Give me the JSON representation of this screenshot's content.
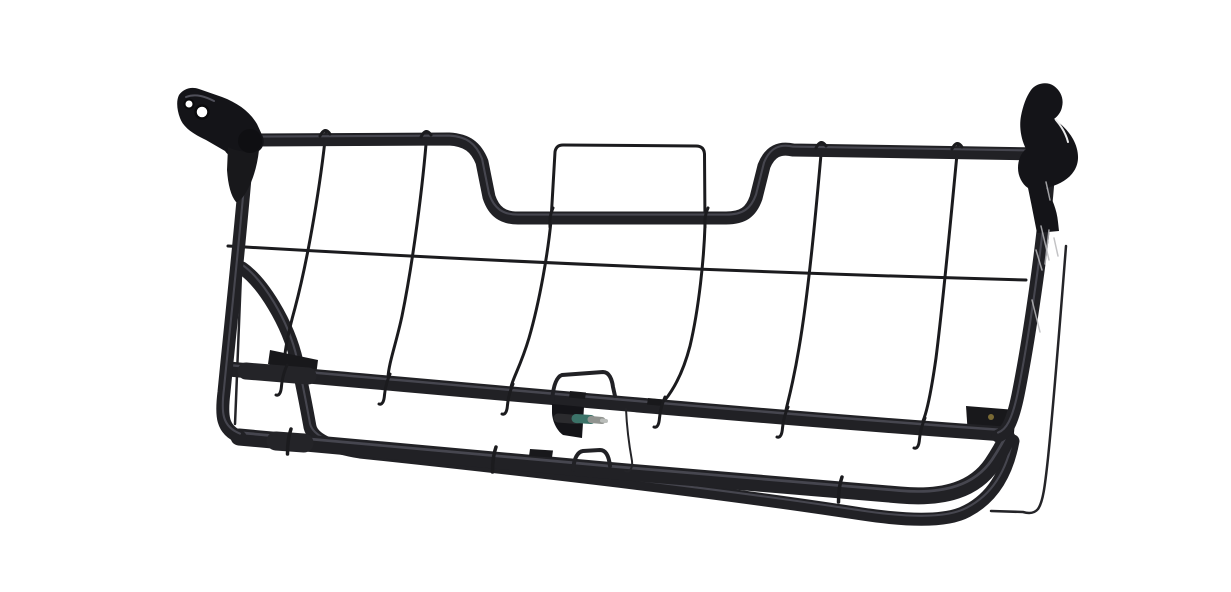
{
  "scene": {
    "type": "product-photo",
    "subject": "Black tubular steel rack frame with wire mesh back panel, mounting brackets and latch bolt",
    "background_color": "#ffffff"
  },
  "art": {
    "viewbox": "0 0 1231 592",
    "palette": {
      "bg": "#ffffff",
      "tube": "#212125",
      "tubeDark": "#18181b",
      "wire": "#1b1b1e",
      "wire2": "#242428",
      "plate": "#141418",
      "boss": "#0f0f12",
      "sheen": "#50505a",
      "scratch": "#b9b9bc",
      "teal": "#3b7268",
      "bolt": "#2b2b2e",
      "boltTip": "#90938f",
      "boltTipEnd": "#babdba",
      "gold": "#7a6a35",
      "notch": "#ececec"
    },
    "parts": [
      {
        "n": "prop-rod-left",
        "t": "path",
        "d": "M 245 175 C 242 250 238 340 236 400 L 235 424",
        "col": "wire2",
        "w": 2.5
      },
      {
        "n": "prop-rod-right",
        "t": "path",
        "d": "M 1066 246 C 1061 310 1054 400 1048 458 C 1045 486 1043 502 1038 509 Q 1033 515 1023 512 L 991 511",
        "col": "wire2",
        "w": 2.5
      },
      {
        "n": "stand-frame-tube",
        "t": "path",
        "d": "M 242 268 C 262 282 288 322 297 362 C 304 393 308 416 310 427 C 313 439 330 447 360 452 C 520 469 720 492 862 514 C 902 520 945 523 967 511 C 996 496 1008 468 1013 441",
        "col": "tube",
        "w": 13,
        "sheen": true
      },
      {
        "n": "mesh-wire-1",
        "t": "path",
        "d": "M 326 131 C 321 180 309 255 295 308 C 288 333 284 352 284 368",
        "col": "wire",
        "w": 3
      },
      {
        "n": "mesh-wire-2",
        "t": "path",
        "d": "M 427 132 C 423 185 413 262 402 316 C 396 344 389 362 388 377",
        "col": "wire",
        "w": 3
      },
      {
        "n": "mesh-wire-3",
        "t": "path",
        "d": "M 551 221 C 548 252 540 300 529 338 C 521 365 513 378 511 387",
        "col": "wire",
        "w": 3
      },
      {
        "n": "mesh-wire-4",
        "t": "path",
        "d": "M 705 225 C 704 258 699 308 690 346 C 683 373 673 390 665 400",
        "col": "wire",
        "w": 3
      },
      {
        "n": "mesh-wire-5",
        "t": "path",
        "d": "M 822 143 C 817 200 809 290 799 348 C 793 384 788 401 786 410",
        "col": "wire",
        "w": 3
      },
      {
        "n": "mesh-wire-6",
        "t": "path",
        "d": "M 958 144 C 952 205 944 295 936 358 C 930 400 926 414 923 421",
        "col": "wire",
        "w": 3
      },
      {
        "n": "center-wire-loop",
        "t": "path",
        "d": "M 551 221 L 555 152 Q 556 145 563 145 L 696 146 Q 704 146 704.5 154 L 705 225",
        "col": "wire",
        "w": 3
      },
      {
        "n": "horizontal-mesh-wire",
        "t": "path",
        "d": "M 228 246 Q 620 269 1026 280",
        "col": "wire",
        "w": 3
      },
      {
        "n": "hinge-ear-left",
        "t": "poly",
        "pts": "270,350 318,360 316,376 268,364",
        "col": "tubeDark"
      },
      {
        "n": "corner-gusset-right",
        "t": "poly",
        "pts": "966,406 1016,410 1013,444 968,436",
        "col": "tubeDark"
      },
      {
        "n": "gusset-bolt-speck",
        "t": "circle",
        "cx": 991,
        "cy": 417,
        "r": 3,
        "col": "gold"
      },
      {
        "n": "middle-rail",
        "t": "path",
        "d": "M 228 369 C 470 390 760 417 1004 434",
        "col": "tube",
        "w": 15,
        "sheen": true
      },
      {
        "n": "middle-rail-sleeve",
        "t": "path",
        "d": "M 246 371 L 308 376",
        "col": "wire2",
        "w": 17
      },
      {
        "n": "bottom-rail",
        "t": "path",
        "d": "M 239 437 C 430 455 690 478 900 495 C 945 499 975 489 992 464 Q 1002 449 1007 438",
        "col": "tube",
        "w": 17,
        "sheen": true
      },
      {
        "n": "bottom-rail-collar",
        "t": "path",
        "d": "M 276 441 L 304 443",
        "col": "wire2",
        "w": 19
      },
      {
        "n": "left-post",
        "t": "path",
        "d": "M 247 154 C 241 230 230 330 224 392 C 221 416 222 430 240 437",
        "col": "tube",
        "w": 13,
        "sheen": true
      },
      {
        "n": "right-post",
        "t": "path",
        "d": "M 1048 180 C 1043 245 1029 340 1018 395 C 1012 424 1006 433 998 436",
        "col": "tube",
        "w": 13,
        "sheen": true
      },
      {
        "n": "top-rail",
        "t": "path",
        "d": "M 254 140 L 449 139 C 467 140 476 147 482 162 L 489 197 C 494 212 503 218 518 218 L 726 218 C 743 218 751 212 756 198 L 764 166 C 770 151 780 147 793 150 L 1043 154",
        "col": "tube",
        "w": 13,
        "sheen": true
      },
      {
        "n": "mid-rail-handle",
        "t": "path",
        "d": "M 552 402 C 553 387 556 377 562 375 L 603 372 C 609 372 612 379 613 387 L 615 396",
        "col": "tube",
        "w": 4
      },
      {
        "n": "bottom-rail-handle",
        "t": "path",
        "d": "M 573 470 C 574 459 577 452 583 451 L 600 450 C 606 450 609 457 610 466",
        "col": "tube",
        "w": 4
      },
      {
        "n": "latch-bracket-plate",
        "t": "fill",
        "d": "M 552 404 L 584 407 L 582 438 L 563 435 C 556 430 552 420 552 412 Z",
        "col": "plate"
      },
      {
        "n": "latch-bolt-shaft",
        "t": "path",
        "d": "M 558 418 L 577 419.5",
        "col": "bolt",
        "w": 9
      },
      {
        "n": "latch-bolt-threadlocker",
        "t": "path",
        "d": "M 576 418.5 L 591 419.5",
        "col": "teal",
        "w": 9
      },
      {
        "n": "latch-bolt-tip",
        "t": "path",
        "d": "M 591 419.5 L 602 420.5",
        "col": "boltTip",
        "w": 7
      },
      {
        "n": "latch-bolt-tip-end",
        "t": "path",
        "d": "M 602 420.5 L 606 421",
        "col": "boltTipEnd",
        "w": 4
      },
      {
        "n": "latch-hanging-wire",
        "t": "path",
        "d": "M 626 409 C 627 432 630 450 632 461 C 633 469 629 473 625 471",
        "col": "wire2",
        "w": 2
      },
      {
        "n": "rail-tab-1",
        "t": "poly",
        "pts": "570,391 586,392.5 585,399 569,397.5",
        "col": "tubeDark"
      },
      {
        "n": "rail-tab-2",
        "t": "poly",
        "pts": "648,398 664,399.5 663,406 647,404.5",
        "col": "tubeDark"
      },
      {
        "n": "rail-tab-3",
        "t": "poly",
        "pts": "530,449 553,450.5 552,457.5 529,456",
        "col": "tubeDark"
      },
      {
        "n": "left-bracket-plate",
        "t": "fill",
        "d": "M 179 95 C 183 89 191 86 199 89 L 222 97 C 238 103 250 112 257 124 L 263 137 C 265 143 263 149 257 152 L 243 157 C 236 159 229 157 225 151 L 206 140 C 193 134 183 127 180 118 C 177 110 176 101 179 95 Z",
        "col": "plate"
      },
      {
        "n": "left-bracket-highlight",
        "t": "path",
        "d": "M 186 97 C 196 93 206 97 214 101",
        "col": "sheen",
        "w": 2
      },
      {
        "n": "left-bracket-hole-small",
        "t": "circle",
        "cx": 189,
        "cy": 104,
        "r": 4.5,
        "col": "bg",
        "stroke": "#0b0b0d",
        "sw": 2
      },
      {
        "n": "left-bracket-hole-large",
        "t": "circle",
        "cx": 202,
        "cy": 112,
        "r": 6.5,
        "col": "bg",
        "stroke": "#0b0b0d",
        "sw": 2.5
      },
      {
        "n": "left-corner-body",
        "t": "fill",
        "d": "M 228 147 C 238 152 250 153 259 150 C 257 168 252 183 245 194 C 242 199 238 202 236 202 C 231 196 228 185 227 170 Z",
        "col": "tubeDark"
      },
      {
        "n": "left-rail-boss",
        "t": "circle",
        "cx": 250,
        "cy": 141,
        "r": 12,
        "col": "boss"
      },
      {
        "n": "right-bracket-body",
        "t": "fill",
        "d": "M 1031 90 C 1036 83 1047 81 1054 86 C 1061 91 1064 99 1062 107 C 1061 112 1058 116 1054 119 C 1060 123 1068 130 1073 139 C 1079 150 1080 162 1074 171 C 1069 179 1060 184 1050 187 L 1046 188 C 1052 198 1057 210 1058 222 L 1059 231 L 1037 233 C 1034 218 1031 202 1028 188 C 1022 184 1018 176 1018 168 C 1018 160 1021 153 1026 149 C 1021 139 1019 127 1021 116 C 1023 106 1026 97 1031 90 Z",
        "col": "plate"
      },
      {
        "n": "right-bracket-notch",
        "t": "path",
        "d": "M 1056 120 C 1062 127 1066 134 1068 142",
        "col": "notch",
        "w": 2
      }
    ],
    "mesh": {
      "wrap_points": [
        [
          284,
          375
        ],
        [
          387,
          384
        ],
        [
          510,
          394
        ],
        [
          662,
          407
        ],
        [
          785,
          417
        ],
        [
          922,
          428
        ]
      ],
      "hook_points": [
        [
          326,
          133
        ],
        [
          427,
          134
        ],
        [
          822,
          145
        ],
        [
          958,
          146
        ]
      ],
      "dip_wrap_points": [
        [
          551,
          217
        ],
        [
          706,
          217
        ]
      ],
      "clip_points": [
        [
          289,
          442
        ],
        [
          494,
          460
        ],
        [
          840,
          490
        ]
      ]
    },
    "scratches": [
      [
        1041,
        226,
        1049,
        260
      ],
      [
        1049,
        230,
        1045,
        264
      ],
      [
        1054,
        238,
        1058,
        256
      ],
      [
        1032,
        300,
        1040,
        332
      ],
      [
        1046,
        182,
        1050,
        200
      ],
      [
        1036,
        250,
        1042,
        270
      ]
    ]
  }
}
